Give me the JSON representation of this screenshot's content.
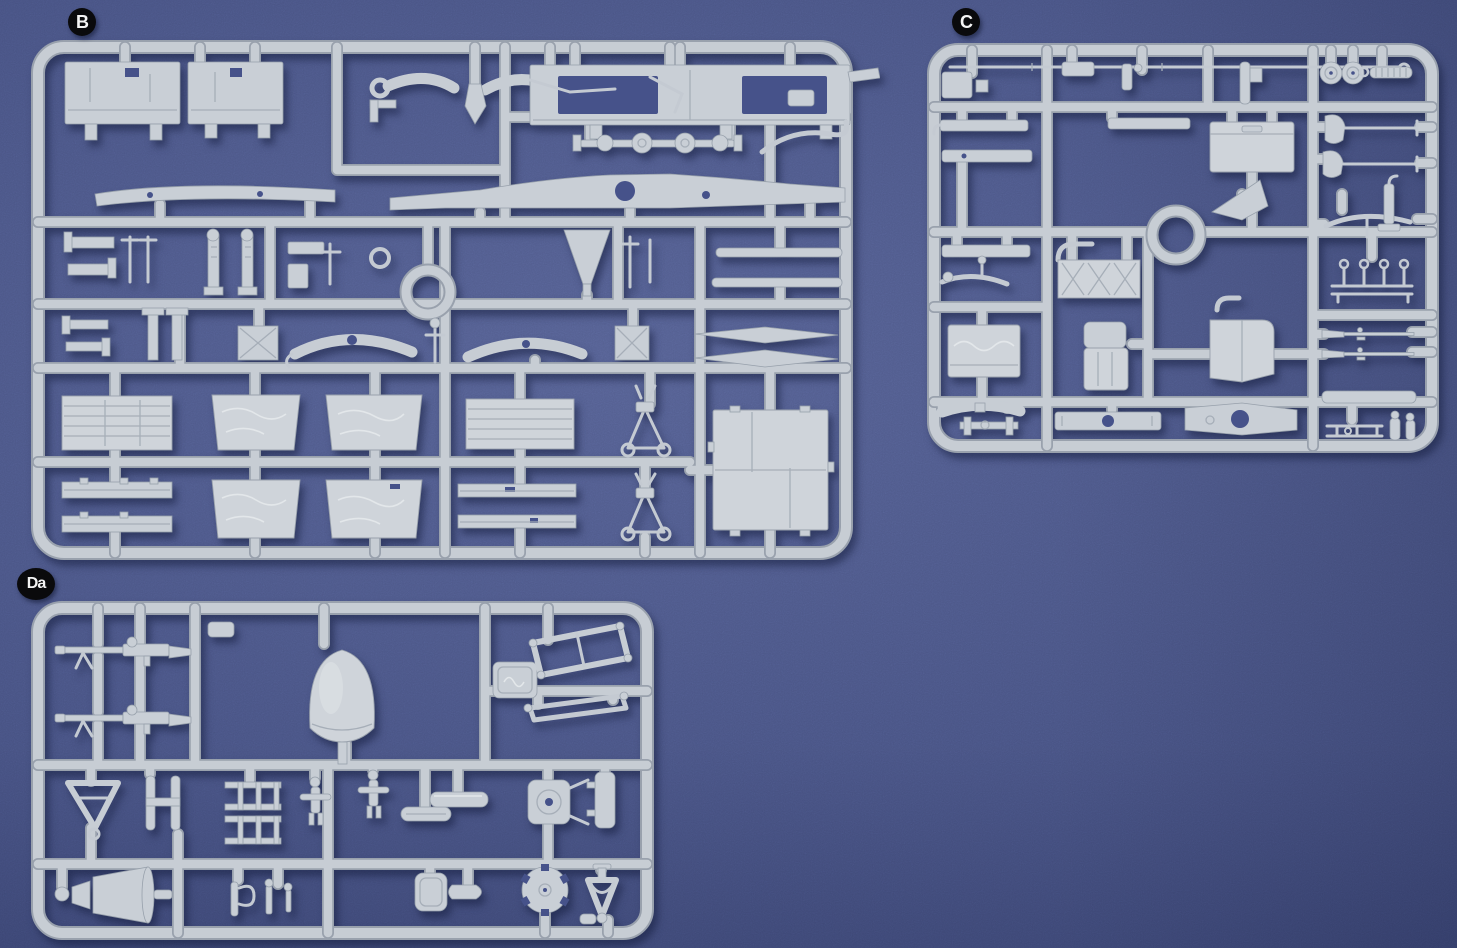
{
  "photo": {
    "subject": "Three injection-molded light-grey model kit sprues photographed on a blue textured cloth background",
    "background_color": "#49558a",
    "plastic_color": "#c9cfd6",
    "badge_background": "#0a0a0c",
    "badge_text_color": "#f4f4f4"
  },
  "sprues": [
    {
      "label": "B",
      "position": "upper-left",
      "contents": "cab panels with window openings, chassis rails, ring, cargo-bed panels, large roof plate, MG mounts"
    },
    {
      "label": "C",
      "position": "upper-right",
      "contents": "bars, tool shovels and pickaxe, wheels, ring, X-braced box, seats, rifles, leaf springs"
    },
    {
      "label": "Da",
      "position": "lower-left",
      "contents": "two machine guns, dome seat shell, logo tag, windscreen frames, levers, horn cones, notched wheel, tow fork"
    }
  ]
}
